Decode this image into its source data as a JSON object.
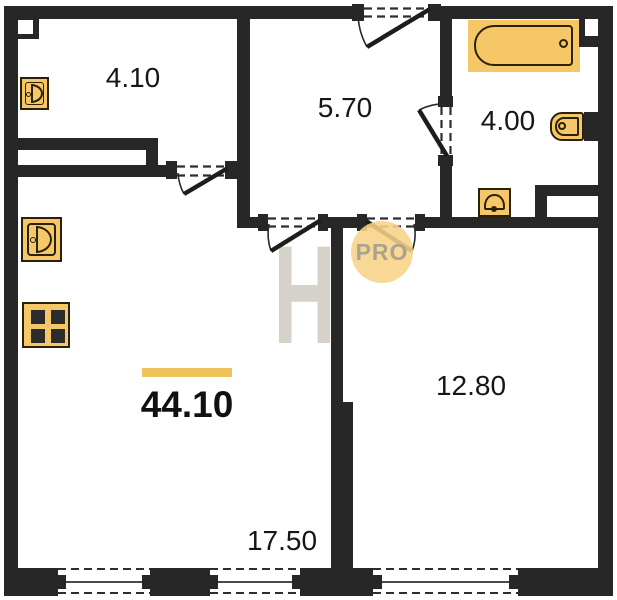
{
  "floorplan": {
    "total_area": "44.10",
    "rooms": [
      {
        "name": "storage",
        "area": "4.10"
      },
      {
        "name": "hallway",
        "area": "5.70"
      },
      {
        "name": "bathroom",
        "area": "4.00"
      },
      {
        "name": "bedroom",
        "area": "12.80"
      },
      {
        "name": "living-kitchen",
        "area": "17.50"
      }
    ],
    "watermark": {
      "letter": "H",
      "badge": "PRO"
    },
    "fixtures": [
      "bathtub-icon",
      "toilet-icon",
      "sink-icon",
      "washing-machine-icon",
      "washing-machine-icon",
      "stove-icon"
    ],
    "colors": {
      "wall": "#272727",
      "fixture_fill": "#f6c766",
      "fixture_stroke": "#2b2107",
      "accent_bar": "#efc45c",
      "badge_bg": "#f7d385",
      "badge_text": "#aba28f",
      "watermark": "#d6d2ca",
      "line": "#2e2e2e"
    }
  }
}
